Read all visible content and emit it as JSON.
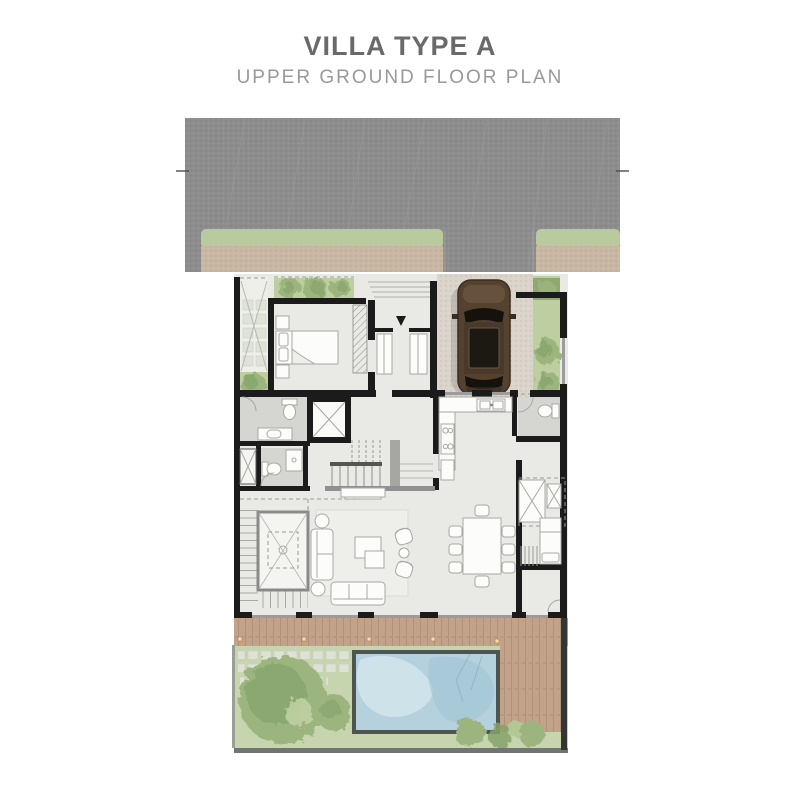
{
  "header": {
    "title": "VILLA TYPE A",
    "subtitle": "UPPER GROUND FLOOR PLAN"
  },
  "colors": {
    "title_color": "#696a6c",
    "subtitle_color": "#97999b",
    "road": "#8d8d8d",
    "sidewalk_grass": "#b9cb9e",
    "sidewalk_paver": "#c8b7a3",
    "wall": "#1b1b1b",
    "floor": "#e9e9e6",
    "bath_floor": "#d5d5d2",
    "driveway": "#dad4ca",
    "grass": "#bdcfa0",
    "tree": "#9cb47e",
    "tree_dark": "#85a269",
    "deck": "#c2a38a",
    "lawn": "#c7d5ae",
    "pool_water": "#b5d1dd",
    "pool_border": "#4e5450",
    "car_body": "#54422f",
    "furniture_stroke": "#a8a8a3"
  }
}
